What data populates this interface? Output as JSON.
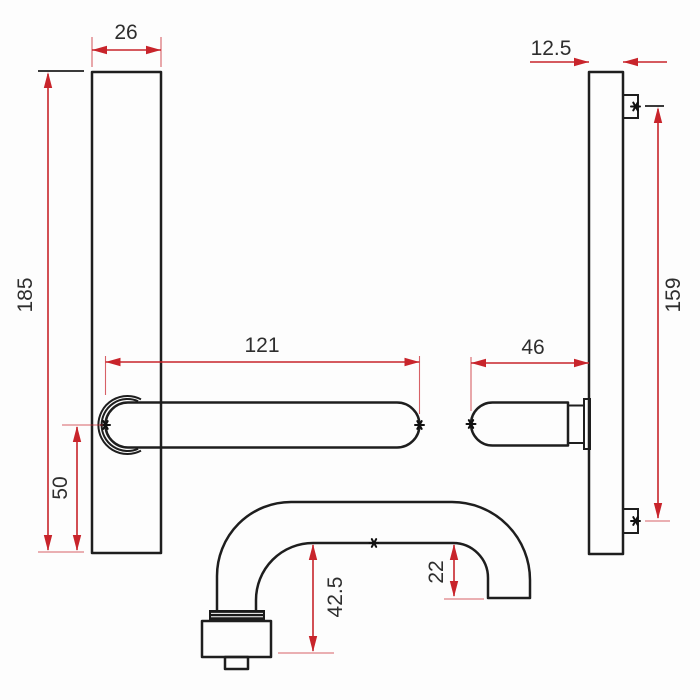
{
  "drawing": {
    "type": "technical-dimension-drawing",
    "subject": "door-handle-with-backplate",
    "colors": {
      "outline": "#1e1e1e",
      "dimension": "#c8242b",
      "label_text": "#2e2e2e",
      "background": "#fdfdfd"
    },
    "icons": {
      "reference_marker": "six-point-star"
    },
    "dimensions": {
      "plate_width": "26",
      "plate_height": "185",
      "lever_length": "121",
      "handle_centre_from_plate_bottom": "50",
      "plate_thickness": "12.5",
      "fixing_centres": "159",
      "lever_projection_side": "46",
      "handle_projection": "42.5",
      "grip_clearance": "22"
    }
  }
}
